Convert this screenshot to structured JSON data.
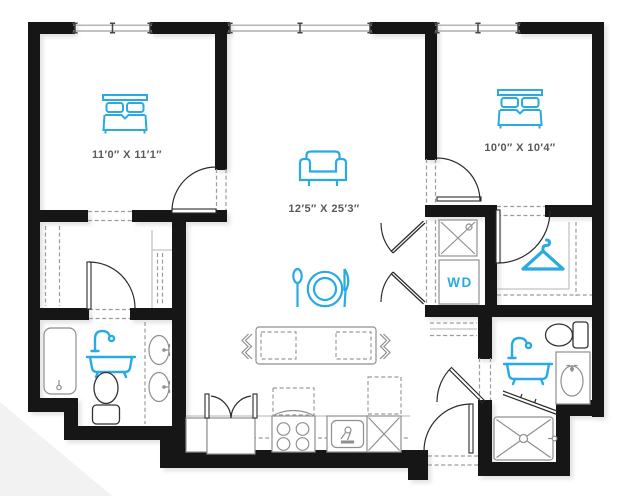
{
  "floor_plan": {
    "type": "apartment-two-bed-two-bath",
    "labels": {
      "bedroom_1_dimensions": "11′0″ X 11′1″",
      "living_dining_dimensions": "12′5″ X 25′3″",
      "bedroom_2_dimensions": "10′0″ X 10′4″",
      "washer_dryer": "WD"
    },
    "colors": {
      "accent": "#29ABE2",
      "walls": "#171717",
      "fixtures": "#8F8F8F",
      "labels": "#58595B",
      "background": "#FFFFFF",
      "corner_shade": "#F2F2F2"
    },
    "rooms": [
      "bedroom-1",
      "living-dining-kitchen",
      "bedroom-2",
      "bathroom-1",
      "bathroom-2",
      "walk-in-closet",
      "laundry-closet",
      "entry"
    ],
    "windows": 3,
    "fixtures": [
      "bed",
      "bed",
      "sofa",
      "dining-place-setting",
      "clothes-hanger",
      "bathtub-with-shower",
      "bathtub-with-shower",
      "shower-tub-stall",
      "walk-in-shower",
      "toilet",
      "toilet",
      "double-vanity-sinks",
      "vanity-sink",
      "stacked-washer-dryer",
      "washer",
      "refrigerator",
      "range-with-hood",
      "kitchen-sink",
      "dishwasher",
      "pantry",
      "kitchen-island-with-seating"
    ]
  }
}
